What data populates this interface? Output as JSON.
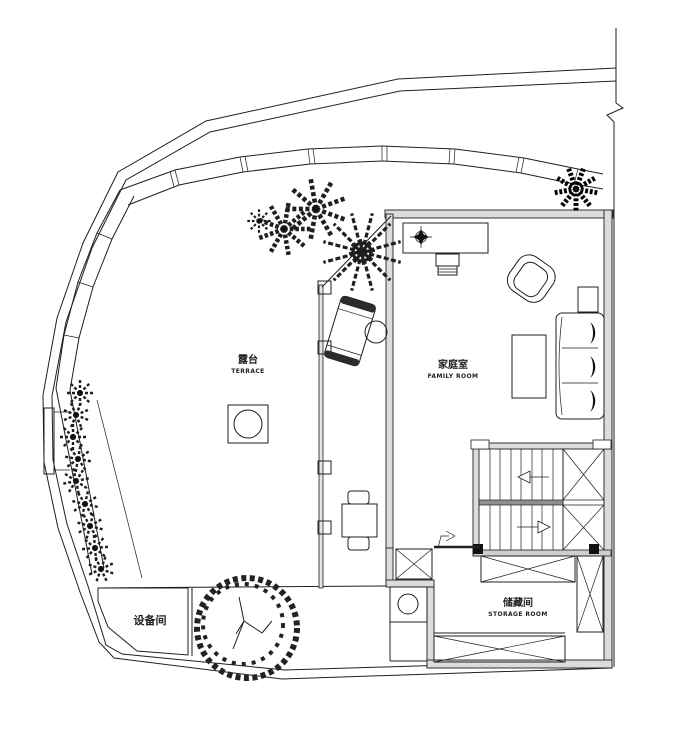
{
  "plan": {
    "title": "first floor terrace plan",
    "colors": {
      "background": "#ffffff",
      "line": "#1f1f1f",
      "wall_fill": "#dcdcdc",
      "stair_rail": "#8f8f8f"
    },
    "rooms": {
      "terrace": {
        "label_zh": "露台",
        "label_en": "TERRACE"
      },
      "family_room": {
        "label_zh": "家庭室",
        "label_en": "FAMILY ROOM"
      },
      "storage_room": {
        "label_zh": "储藏间",
        "label_en": "STORAGE ROOM"
      },
      "equipment_room": {
        "label_zh": "设备间"
      }
    },
    "symbols": [
      "site-boundary",
      "boundary-break-mark",
      "retaining-wall",
      "planting-strip",
      "shrub-plant",
      "palm-tree",
      "tropical-plant",
      "deciduous-tree",
      "stairs-up-arrow",
      "stairs-down-arrow",
      "entry-arrow",
      "crossed-storage-box",
      "fire-pit",
      "chaise-lounge",
      "sofa",
      "desk",
      "armchair",
      "dining-set"
    ]
  }
}
